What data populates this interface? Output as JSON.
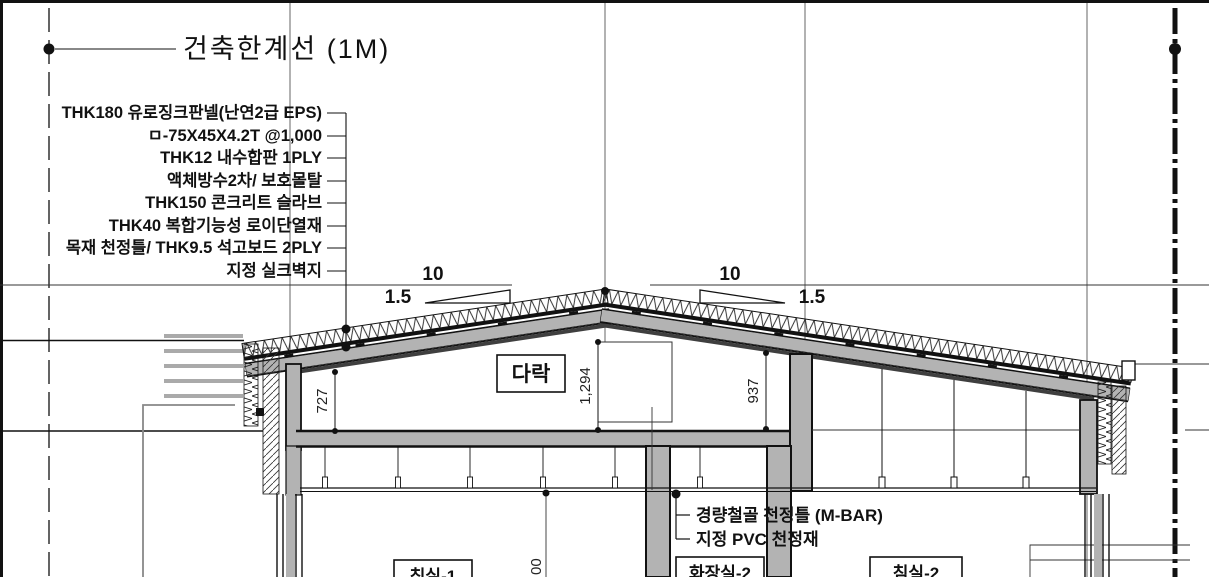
{
  "drawing": {
    "title": "건축한계선 (1M)",
    "materials": [
      "THK180 유로징크판넬(난연2급 EPS)",
      "ㅁ-75X45X4.2T @1,000",
      "THK12 내수합판 1PLY",
      "액체방수2차/ 보호몰탈",
      "THK150 콘크리트 슬라브",
      "THK40 복합기능성 로이단열재",
      "목재 천정틀/ THK9.5 석고보드 2PLY",
      "지정 실크벽지"
    ],
    "slope": {
      "run": "10",
      "rise": "1.5"
    },
    "dims": {
      "attic_left": "727",
      "attic_center": "1,294",
      "attic_right": "937",
      "floor_partial": "00"
    },
    "rooms": {
      "attic": "다락",
      "room1": "침실-1",
      "room2": "화장실-2",
      "room3": "침실-2"
    },
    "ceiling_callouts": [
      "경량철골 천정틀 (M-BAR)",
      "지정 PVC 천정재"
    ],
    "colors": {
      "line": "#111111",
      "concrete_gray": "#b3b3b3",
      "dark_band": "#3f3f3f",
      "louver_gray": "#aaaaaa"
    }
  }
}
